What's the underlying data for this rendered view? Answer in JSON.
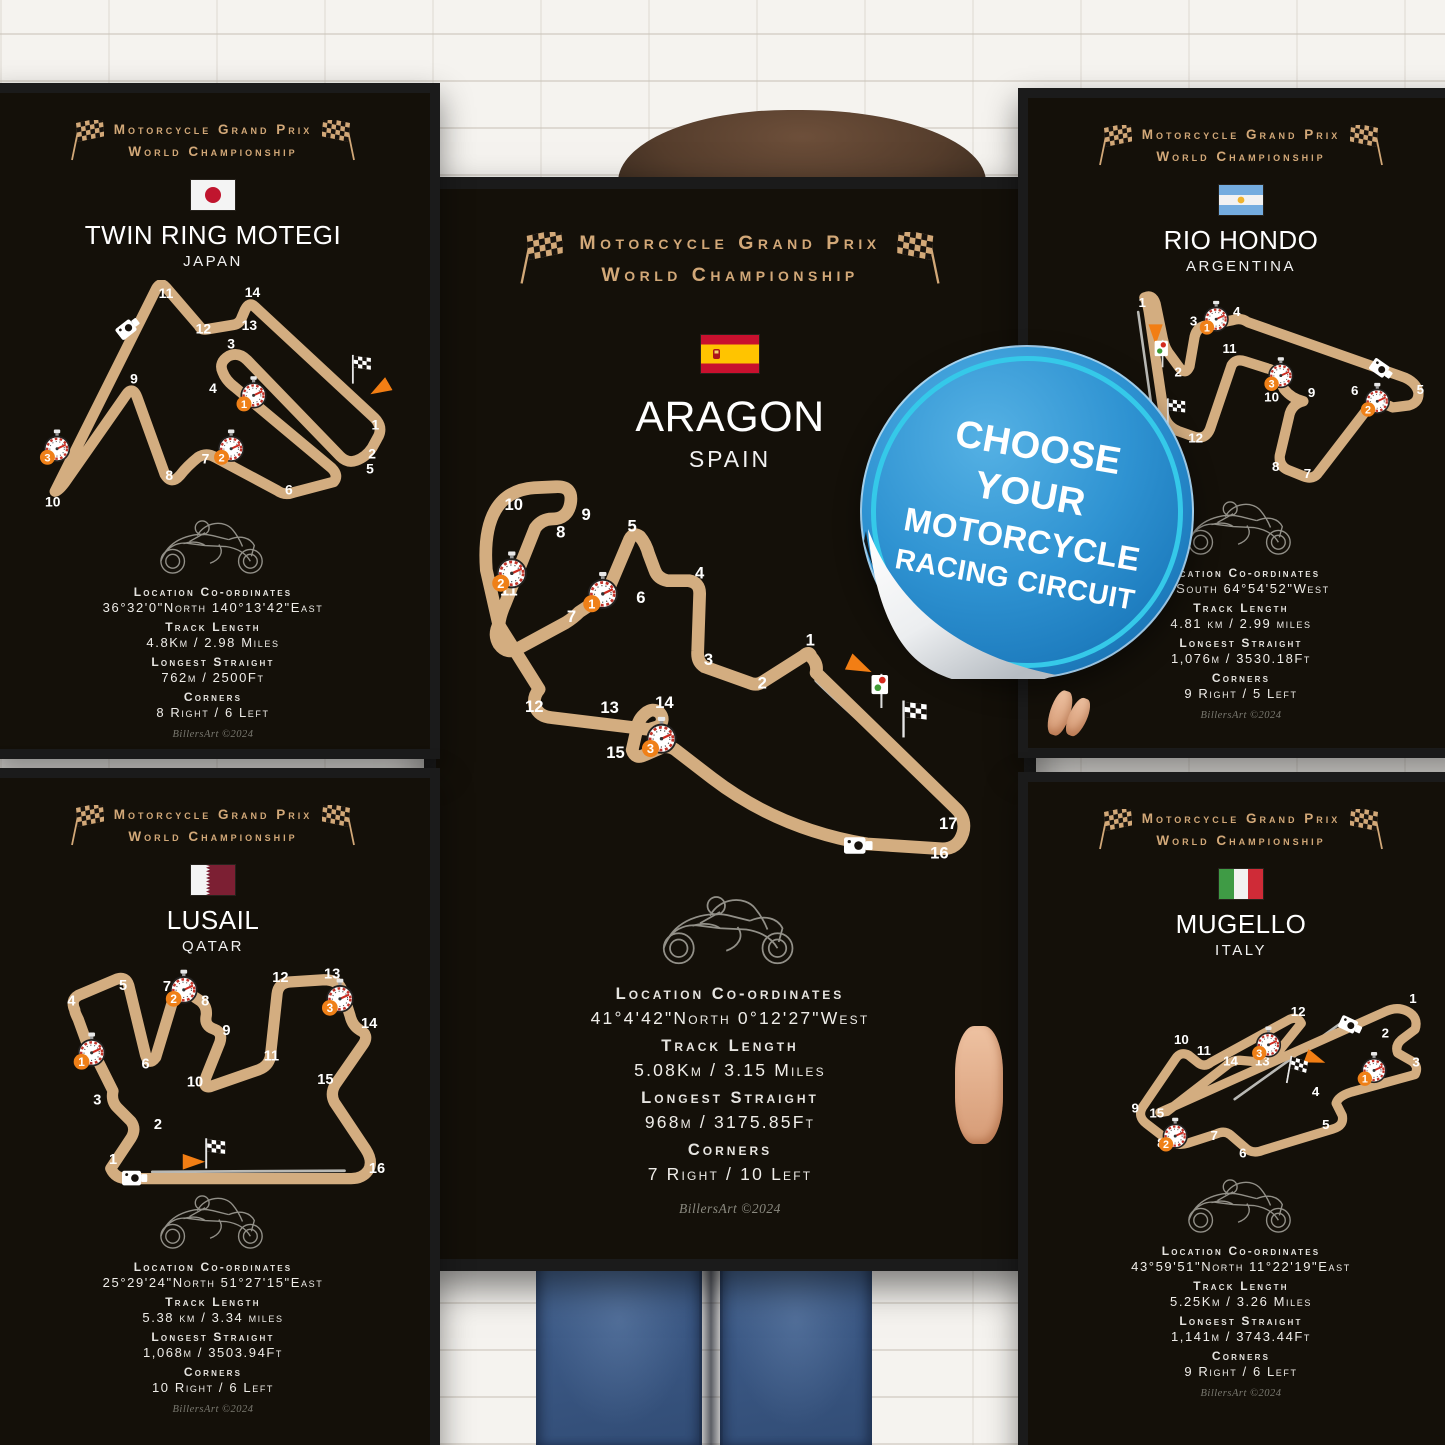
{
  "scene": {
    "sticker": {
      "lines": [
        "CHOOSE",
        "YOUR",
        "MOTORCYCLE",
        "RACING CIRCUIT"
      ],
      "blue": "#2f93d2",
      "ring": "#35c9e9"
    },
    "shared": {
      "header_line1": "Motorcycle Grand Prix",
      "header_line2": "World Championship",
      "labels": {
        "location": "Location Co-ordinates",
        "track_length": "Track Length",
        "longest_straight": "Longest Straight",
        "corners": "Corners"
      },
      "signature": "BillersArt ©2024",
      "colors": {
        "gold": "#d2a878",
        "track": "#d3ad80",
        "poster_bg": "#141009",
        "sector_badge": "#ef8018"
      }
    }
  },
  "posters": [
    {
      "id": "motegi",
      "position": "top-left",
      "name": "TWIN RING MOTEGI",
      "country": "JAPAN",
      "flag": "japan",
      "stats": {
        "location": "36°32'0\"North 140°13'42\"East",
        "track_length": "4.8Km / 2.98 Miles",
        "longest_straight": "762m / 2500Ft",
        "corners": "8 Right / 6 Left"
      },
      "circuit": {
        "label_size": 13,
        "sw_scale": 1,
        "corners": [
          {
            "n": "1",
            "x": 327,
            "y": 140
          },
          {
            "n": "2",
            "x": 324,
            "y": 167
          },
          {
            "n": "3",
            "x": 192,
            "y": 64
          },
          {
            "n": "4",
            "x": 175,
            "y": 106
          },
          {
            "n": "5",
            "x": 322,
            "y": 181
          },
          {
            "n": "6",
            "x": 246,
            "y": 201
          },
          {
            "n": "7",
            "x": 168,
            "y": 172
          },
          {
            "n": "8",
            "x": 134,
            "y": 187
          },
          {
            "n": "9",
            "x": 101,
            "y": 97
          },
          {
            "n": "10",
            "x": 25,
            "y": 212
          },
          {
            "n": "11",
            "x": 131,
            "y": 17
          },
          {
            "n": "12",
            "x": 166,
            "y": 50
          },
          {
            "n": "13",
            "x": 209,
            "y": 47
          },
          {
            "n": "14",
            "x": 212,
            "y": 16
          }
        ],
        "sectors": [
          {
            "n": "1",
            "x": 213,
            "y": 106
          },
          {
            "n": "2",
            "x": 192,
            "y": 156
          },
          {
            "n": "3",
            "x": 29,
            "y": 156
          }
        ]
      }
    },
    {
      "id": "lusail",
      "position": "bottom-left",
      "name": "LUSAIL",
      "country": "QATAR",
      "flag": "qatar",
      "stats": {
        "location": "25°29'24\"North 51°27'15\"East",
        "track_length": "5.38 km / 3.34 miles",
        "longest_straight": "1,068m / 3503.94Ft",
        "corners": "10 Right / 6 Left"
      },
      "circuit": {
        "label_size": 13,
        "sw_scale": 1,
        "corners": [
          {
            "n": "1",
            "x": 81,
            "y": 177
          },
          {
            "n": "2",
            "x": 121,
            "y": 146
          },
          {
            "n": "3",
            "x": 67,
            "y": 124
          },
          {
            "n": "4",
            "x": 44,
            "y": 36
          },
          {
            "n": "5",
            "x": 90,
            "y": 22
          },
          {
            "n": "6",
            "x": 110,
            "y": 92
          },
          {
            "n": "7",
            "x": 129,
            "y": 23
          },
          {
            "n": "8",
            "x": 163,
            "y": 36
          },
          {
            "n": "9",
            "x": 182,
            "y": 62
          },
          {
            "n": "10",
            "x": 154,
            "y": 108
          },
          {
            "n": "11",
            "x": 222,
            "y": 85
          },
          {
            "n": "12",
            "x": 230,
            "y": 15
          },
          {
            "n": "13",
            "x": 276,
            "y": 12
          },
          {
            "n": "14",
            "x": 309,
            "y": 56
          },
          {
            "n": "15",
            "x": 270,
            "y": 106
          },
          {
            "n": "16",
            "x": 316,
            "y": 185
          }
        ],
        "sectors": [
          {
            "n": "1",
            "x": 62,
            "y": 76
          },
          {
            "n": "2",
            "x": 144,
            "y": 20
          },
          {
            "n": "3",
            "x": 283,
            "y": 28
          }
        ]
      }
    },
    {
      "id": "aragon",
      "position": "center",
      "name": "ARAGON",
      "country": "SPAIN",
      "flag": "spain",
      "stats": {
        "location": "41°4'42\"North 0°12'27\"West",
        "track_length": "5.08Km / 3.15 Miles",
        "longest_straight": "968m / 3175.85Ft",
        "corners": "7 Right / 10 Left"
      },
      "circuit": {
        "label_size": 17,
        "sw_scale": 1.25,
        "corners": [
          {
            "n": "1",
            "x": 362,
            "y": 174
          },
          {
            "n": "2",
            "x": 313,
            "y": 218
          },
          {
            "n": "3",
            "x": 258,
            "y": 194
          },
          {
            "n": "4",
            "x": 249,
            "y": 106
          },
          {
            "n": "5",
            "x": 180,
            "y": 58
          },
          {
            "n": "6",
            "x": 189,
            "y": 131
          },
          {
            "n": "7",
            "x": 118,
            "y": 150
          },
          {
            "n": "8",
            "x": 107,
            "y": 64
          },
          {
            "n": "9",
            "x": 133,
            "y": 46
          },
          {
            "n": "10",
            "x": 59,
            "y": 36
          },
          {
            "n": "11",
            "x": 54,
            "y": 123
          },
          {
            "n": "12",
            "x": 80,
            "y": 242
          },
          {
            "n": "13",
            "x": 157,
            "y": 243
          },
          {
            "n": "14",
            "x": 213,
            "y": 238
          },
          {
            "n": "15",
            "x": 163,
            "y": 289
          },
          {
            "n": "16",
            "x": 494,
            "y": 392
          },
          {
            "n": "17",
            "x": 503,
            "y": 362
          }
        ],
        "sectors": [
          {
            "n": "1",
            "x": 150,
            "y": 119
          },
          {
            "n": "2",
            "x": 57,
            "y": 98
          },
          {
            "n": "3",
            "x": 210,
            "y": 267
          }
        ]
      }
    },
    {
      "id": "riohondo",
      "position": "top-right",
      "name": "RIO HONDO",
      "country": "ARGENTINA",
      "flag": "argentina",
      "stats": {
        "location": "21\"South 64°54'52\"West",
        "track_length": "4.81 km / 2.99 miles",
        "longest_straight": "1,076m / 3530.18Ft",
        "corners": "9 Right / 5 Left"
      },
      "circuit": {
        "label_size": 13,
        "sw_scale": 1,
        "corners": [
          {
            "n": "1",
            "x": 86,
            "y": 21
          },
          {
            "n": "2",
            "x": 121,
            "y": 89
          },
          {
            "n": "3",
            "x": 136,
            "y": 39
          },
          {
            "n": "4",
            "x": 178,
            "y": 30
          },
          {
            "n": "5",
            "x": 357,
            "y": 106
          },
          {
            "n": "6",
            "x": 293,
            "y": 107
          },
          {
            "n": "7",
            "x": 247,
            "y": 188
          },
          {
            "n": "8",
            "x": 216,
            "y": 181
          },
          {
            "n": "9",
            "x": 251,
            "y": 109
          },
          {
            "n": "10",
            "x": 212,
            "y": 113
          },
          {
            "n": "11",
            "x": 171,
            "y": 66
          },
          {
            "n": "12",
            "x": 138,
            "y": 153
          }
        ],
        "sectors": [
          {
            "n": "1",
            "x": 158,
            "y": 31
          },
          {
            "n": "2",
            "x": 315,
            "y": 111
          },
          {
            "n": "3",
            "x": 221,
            "y": 86
          }
        ]
      }
    },
    {
      "id": "mugello",
      "position": "bottom-right",
      "name": "MUGELLO",
      "country": "ITALY",
      "flag": "italy",
      "stats": {
        "location": "43°59'51\"North 11°22'19\"East",
        "track_length": "5.25Km / 3.26 Miles",
        "longest_straight": "1,141m / 3743.44Ft",
        "corners": "9 Right / 6 Left"
      },
      "circuit": {
        "label_size": 13,
        "sw_scale": 1,
        "corners": [
          {
            "n": "1",
            "x": 350,
            "y": 33
          },
          {
            "n": "2",
            "x": 323,
            "y": 67
          },
          {
            "n": "3",
            "x": 353,
            "y": 95
          },
          {
            "n": "4",
            "x": 255,
            "y": 124
          },
          {
            "n": "5",
            "x": 265,
            "y": 156
          },
          {
            "n": "6",
            "x": 184,
            "y": 184
          },
          {
            "n": "7",
            "x": 156,
            "y": 167
          },
          {
            "n": "8",
            "x": 104,
            "y": 174
          },
          {
            "n": "9",
            "x": 79,
            "y": 140
          },
          {
            "n": "10",
            "x": 124,
            "y": 73
          },
          {
            "n": "11",
            "x": 146,
            "y": 84
          },
          {
            "n": "12",
            "x": 238,
            "y": 46
          },
          {
            "n": "13",
            "x": 203,
            "y": 94
          },
          {
            "n": "14",
            "x": 172,
            "y": 94
          },
          {
            "n": "15",
            "x": 100,
            "y": 145
          }
        ],
        "sectors": [
          {
            "n": "1",
            "x": 312,
            "y": 97
          },
          {
            "n": "2",
            "x": 118,
            "y": 161
          },
          {
            "n": "3",
            "x": 209,
            "y": 72
          }
        ]
      }
    }
  ]
}
